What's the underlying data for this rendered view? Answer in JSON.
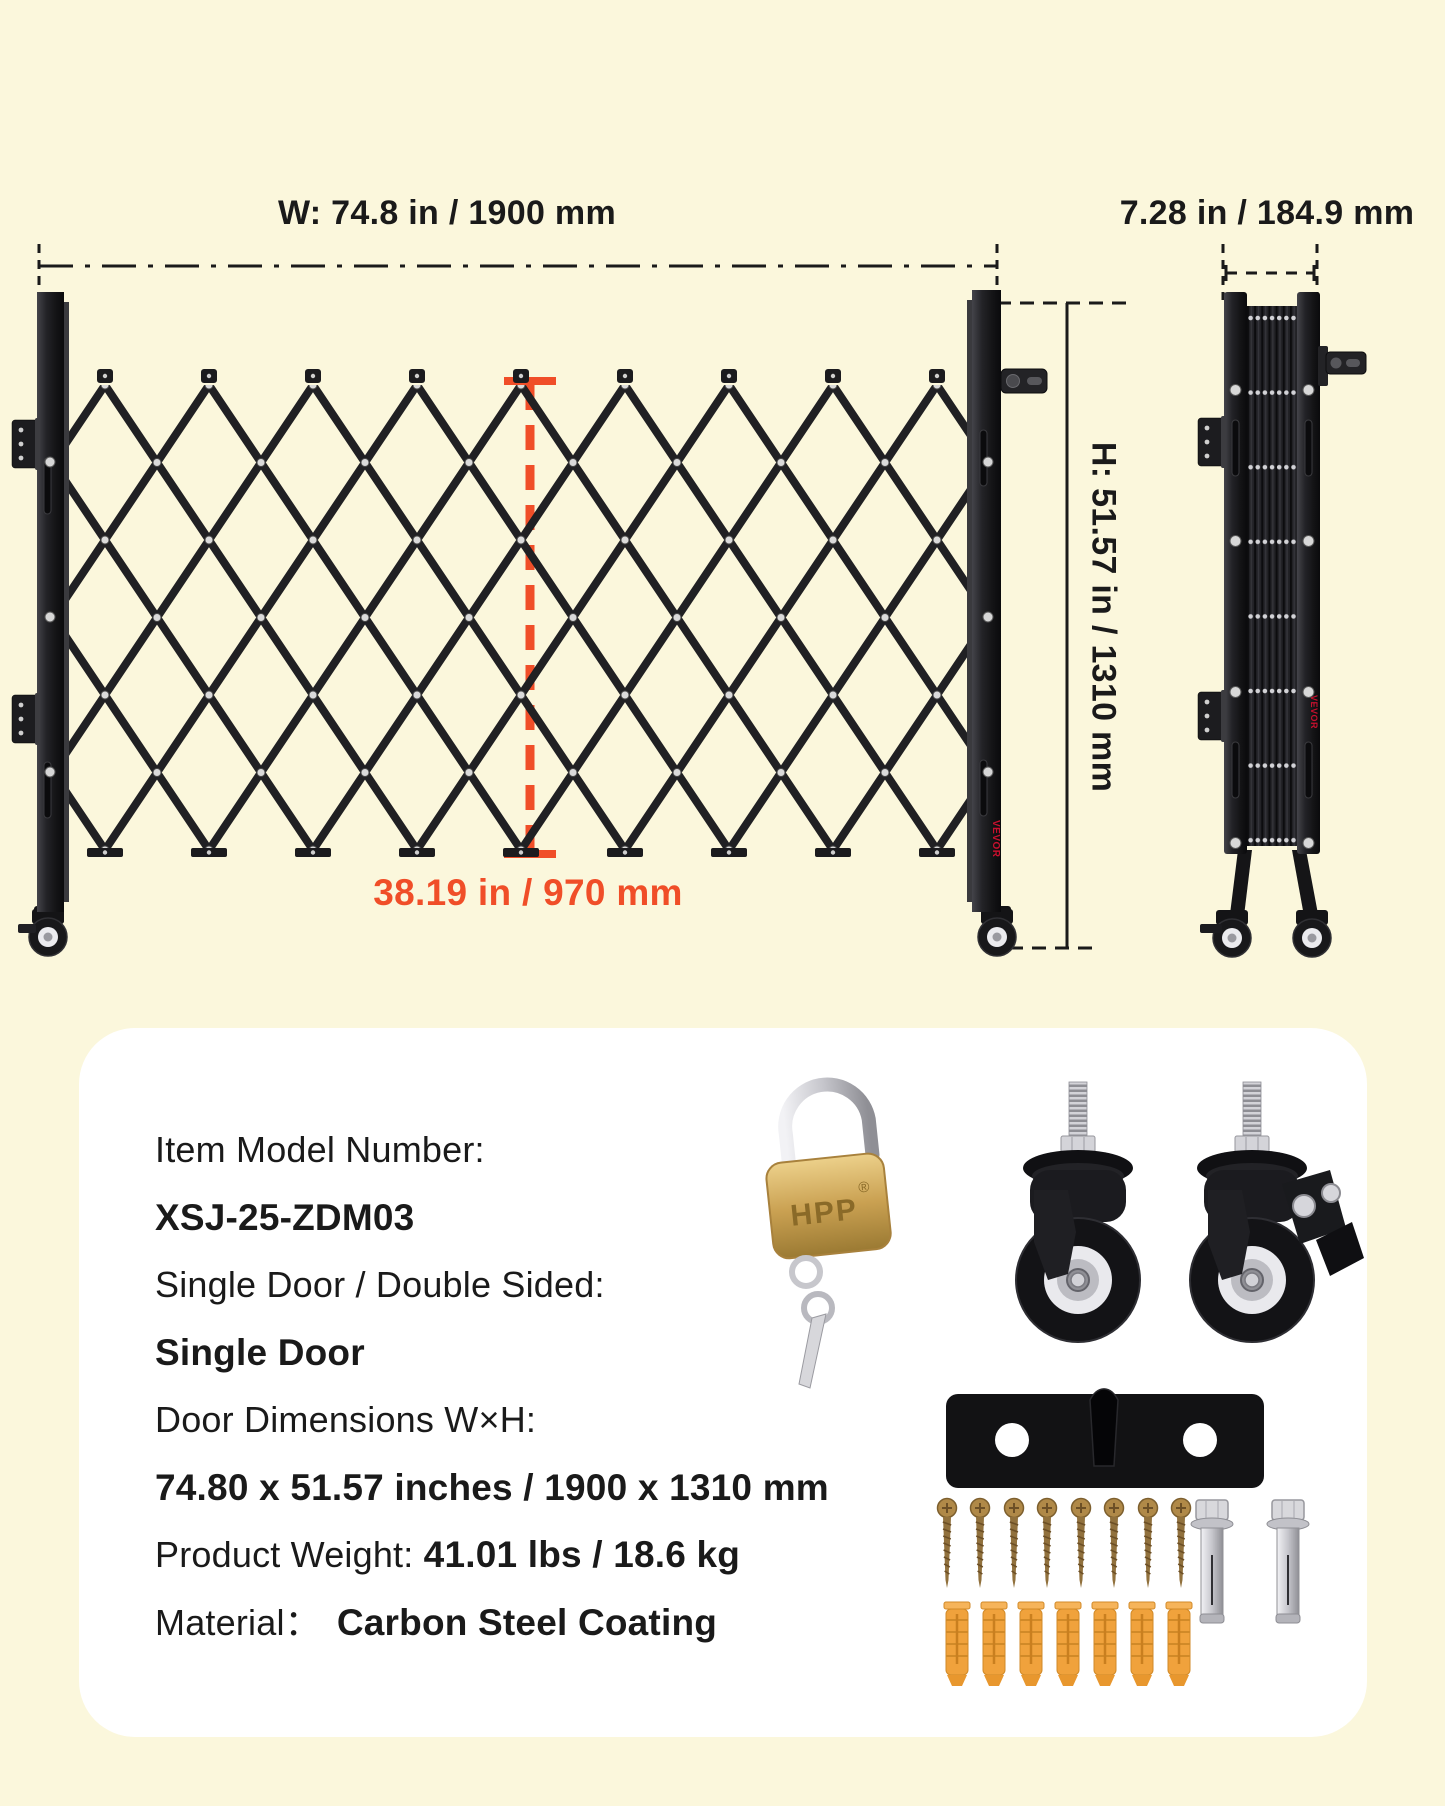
{
  "colors": {
    "background": "#FBF7DC",
    "card": "#FFFFFF",
    "ink": "#1A1A1A",
    "accent": "#F04E28",
    "gate": "#202023",
    "brand": "#C8102E",
    "brass": "#C9A152",
    "anchor": "#F0A23C"
  },
  "diagram": {
    "width_label": "W: 74.8 in / 1900 mm",
    "folded_width_label": "7.28 in / 184.9 mm",
    "height_label": "H: 51.57 in / 1310 mm",
    "section_width_label": "38.19 in / 970 mm",
    "brand": "VEVOR"
  },
  "specs": {
    "model_label": "Item Model Number:",
    "model_value": "XSJ-25-ZDM03",
    "door_type_label": "Single Door / Double Sided:",
    "door_type_value": "Single Door",
    "door_dims_label": "Door Dimensions W×H:",
    "door_dims_value": "74.80 x 51.57 inches / 1900 x 1310 mm",
    "weight_label": "Product Weight: ",
    "weight_value": "41.01 lbs / 18.6 kg",
    "material_label": "Material：",
    "material_value": "Carbon Steel Coating"
  },
  "hardware": {
    "padlock_brand": "HPP",
    "padlock_reg": "®",
    "items": [
      "padlock-with-keys",
      "swivel-caster",
      "swivel-caster-with-brake",
      "mounting-plate",
      "wood-screws-x8",
      "wall-anchors-x7",
      "expansion-bolts-x2"
    ]
  }
}
